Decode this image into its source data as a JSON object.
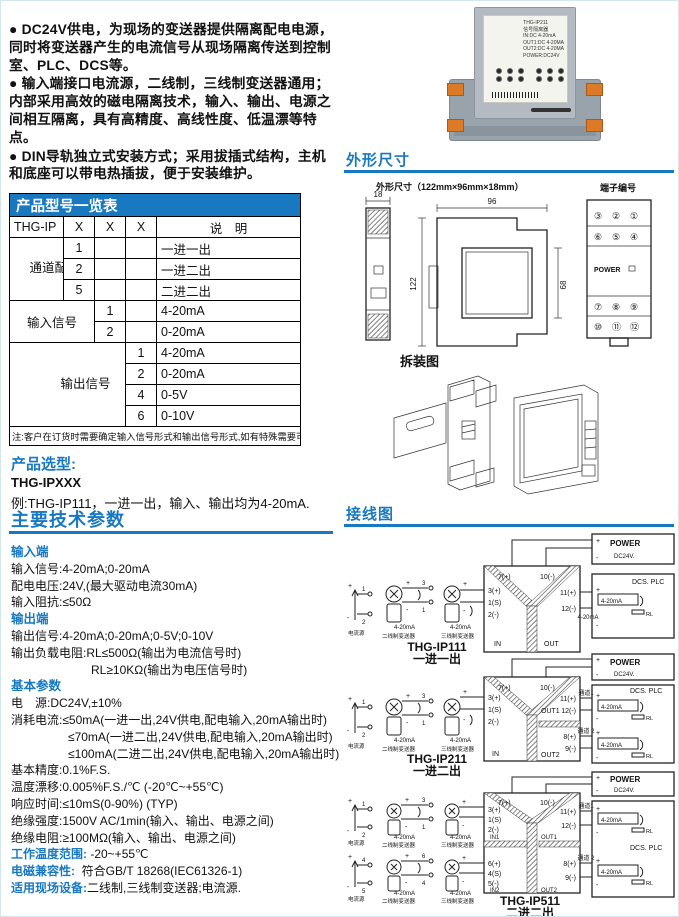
{
  "colors": {
    "accent": "#1879c0",
    "table_header": "#1879c0",
    "terminal_orange": "#dd7a28"
  },
  "intro": {
    "b1": "● DC24V供电，为现场的变送器提供隔离配电电源，同时将变送器产生的电流信号从现场隔离传送到控制室、PLC、DCS等。",
    "b2": "● 输入端接口电流源，二线制，三线制变送器通用；内部采用高效的磁电隔离技术，输入、输出、电源之间相互隔离，具有高精度、高线性度、低温漂等特点。",
    "b3": "● DIN导轨独立式安装方式；采用拔插式结构，主机和底座可以带电热插拔，便于安装维护。"
  },
  "model_table": {
    "title": "产品型号一览表",
    "h": {
      "c0": "THG-IP",
      "c1": "X",
      "c2": "X",
      "c3": "X",
      "c4": "说　明"
    },
    "g1": {
      "label": "通道配置",
      "r1c": "1",
      "r1d": "一进一出",
      "r2c": "2",
      "r2d": "一进二出",
      "r3c": "5",
      "r3d": "二进二出"
    },
    "g2": {
      "label": "输入信号",
      "r1c": "1",
      "r1d": "4-20mA",
      "r2c": "2",
      "r2d": "0-20mA"
    },
    "g3": {
      "label": "输出信号",
      "r1c": "1",
      "r1d": "4-20mA",
      "r2c": "2",
      "r2d": "0-20mA",
      "r3c": "4",
      "r3d": "0-5V",
      "r4c": "6",
      "r4d": "0-10V"
    },
    "note": "注:客户在订货时需要确定输入信号形式和输出信号形式,如有特殊需要可以定制."
  },
  "selection": {
    "title": "产品选型:",
    "model": "THG-IPXXX",
    "example": "例:THG-IP111，一进一出，输入、输出均为4-20mA."
  },
  "params": {
    "title": "主要技术参数",
    "h1": "输入端",
    "in1": "输入信号:4-20mA;0-20mA",
    "in2": "配电电压:24V,(最大驱动电流30mA)",
    "in3": "输入阻抗:≤50Ω",
    "h2": "输出端",
    "out1": "输出信号:4-20mA;0-20mA;0-5V;0-10V",
    "out2": "输出负载电阻:RL≤500Ω(输出为电流信号时)",
    "out2b": "RL≥10KΩ(输出为电压信号时)",
    "h3": "基本参数",
    "b1": "电　源:DC24V,±10%",
    "b2": "消耗电流:≤50mA(一进一出,24V供电,配电输入,20mA输出时)",
    "b2b": "≤70mA(一进二出,24V供电,配电输入,20mA输出时)",
    "b2c": "≤100mA(二进二出,24V供电,配电输入,20mA输出时)",
    "b3": "基本精度:0.1%F.S.",
    "b4": "温度漂移:0.005%F.S./℃ (-20℃~+55℃)",
    "b5": "响应时间:≤10mS(0-90%) (TYP)",
    "b6": "绝缘强度:1500V AC/1min(输入、输出、电源之间)",
    "b7": "绝缘电阻:≥100MΩ(输入、输出、电源之间)",
    "kv1k": "工作温度范围:",
    "kv1v": " -20~+55℃",
    "kv2k": "电磁兼容性:",
    "kv2v": "  符合GB/T 18268(IEC61326-1)",
    "kv3k": "适用现场设备:",
    "kv3v": "二线制,三线制变送器;电流源."
  },
  "photo": {
    "lines": [
      "THG-IP211",
      "信号隔离器",
      "IN:DC 4-20mA",
      "OUT1:DC 4-20MA",
      "OUT2:DC 4-20MA",
      "POWER:DC24V"
    ]
  },
  "outline": {
    "title": "外形尺寸",
    "dims_label": "外形尺寸（122mm×96mm×18mm）",
    "d18": "18",
    "d96": "96",
    "d122": "122",
    "d68": "68",
    "terminal_title": "端子编号",
    "power_label": "POWER",
    "rows": [
      [
        "③",
        "②",
        "①"
      ],
      [
        "⑥",
        "⑤",
        "④"
      ],
      [
        "⑦",
        "⑧",
        "⑨"
      ],
      [
        "⑩",
        "⑪",
        "⑫"
      ]
    ],
    "disassembly_title": "拆装图"
  },
  "wiring": {
    "title": "接线图",
    "sym": {
      "p": "+",
      "m": "-"
    },
    "d1": {
      "src": {
        "t1": "1",
        "t2": "2",
        "cap": "电流源"
      },
      "tw": {
        "n1": "3",
        "n2": "1",
        "ma": "4-20mA",
        "cap": "二线制变送器"
      },
      "th": {
        "ma": "4-20mA",
        "cap": "三线制变送器"
      },
      "box": {
        "t1": "7(+)",
        "t2": "10(-)",
        "l1": "3(+)",
        "l2": "1(S)",
        "l3": "2(-)",
        "in": "IN",
        "out": "OUT",
        "r1": "11(+)",
        "r2": "12(-)"
      },
      "wma": "4-20mA",
      "power": {
        "t": "POWER",
        "v": "DC24V."
      },
      "dcs": {
        "t": "DCS. PLC",
        "ma": "4-20mA",
        "rl": "RL"
      },
      "model": "THG-IP111",
      "sub": "一进一出"
    },
    "d2": {
      "src": {
        "t1": "1",
        "t2": "2",
        "cap": "电流源"
      },
      "tw": {
        "n1": "3",
        "n2": "1",
        "ma": "4-20mA",
        "cap": "二线制变送器"
      },
      "th": {
        "ma": "4-20mA",
        "cap": "三线制变送器"
      },
      "box": {
        "t1": "7(+)",
        "t2": "10(-)",
        "l1": "3(+)",
        "l2": "1(S)",
        "l3": "2(-)",
        "in": "IN",
        "out1": "OUT1",
        "out2": "OUT2",
        "r1": "11(+)",
        "r2": "12(-)",
        "r3": "8(+)",
        "r4": "9(-)"
      },
      "ch1": "通道1",
      "ch2": "通道 2",
      "power": {
        "t": "POWER",
        "v": "DC24V."
      },
      "dcs": {
        "t": "DCS. PLC",
        "ma1": "4-20mA",
        "rl1": "RL",
        "ma2": "4-20mA",
        "rl2": "RL"
      },
      "model": "THG-IP211",
      "sub": "一进二出"
    },
    "d3": {
      "srcA": {
        "t1": "1",
        "t2": "2",
        "cap": "电流源"
      },
      "twA": {
        "n1": "3",
        "n2": "1",
        "ma": "4-20mA",
        "cap": "二线制变送器"
      },
      "thA": {
        "ma": "4-20mA",
        "cap": "三线制变送器"
      },
      "srcB": {
        "t1": "4",
        "t2": "5",
        "cap": "电流源"
      },
      "twB": {
        "n1": "6",
        "n2": "4",
        "ma": "4-20mA",
        "cap": "二线制变送器"
      },
      "thB": {
        "ma": "4-20mA",
        "cap": "三线制变送器"
      },
      "box": {
        "t1": "7(+)",
        "t2": "10(-)",
        "l1": "3(+)",
        "l2": "1(S)",
        "l3": "2(-)",
        "in1": "IN1",
        "l4": "6(+)",
        "l5": "4(S)",
        "l6": "5(-)",
        "in2": "IN2",
        "out1": "OUT1",
        "out2": "OUT2",
        "r1": "11(+)",
        "r2": "12(-)",
        "r3": "8(+)",
        "r4": "9(-)"
      },
      "ch1": "通道1",
      "ch2": "通道 2",
      "power": {
        "t": "POWER",
        "v": "DC24V."
      },
      "dcs": {
        "t": "DCS. PLC",
        "ma1": "4-20mA",
        "rl1": "RL",
        "ma2": "4-20mA",
        "rl2": "RL"
      },
      "model": "THG-IP511",
      "sub": "二进二出"
    }
  }
}
